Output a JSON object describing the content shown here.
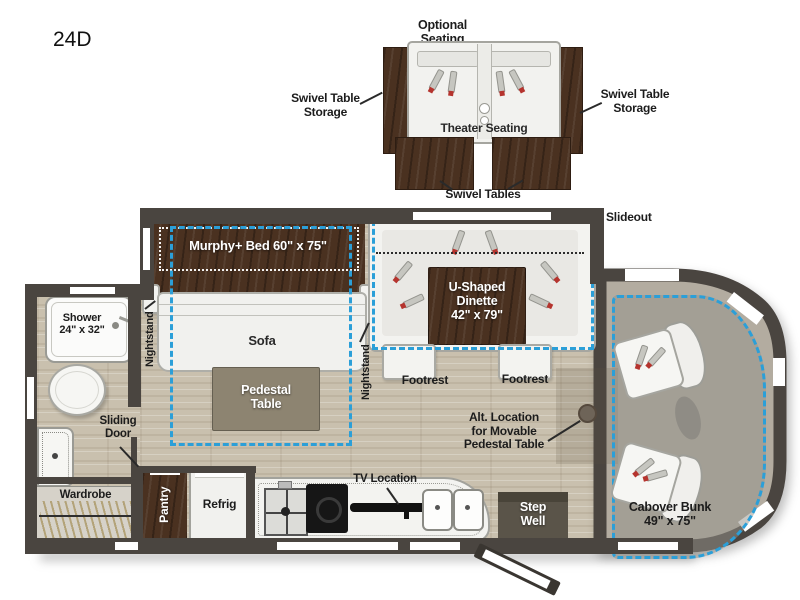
{
  "model": "24D",
  "palette": {
    "wall": "#4a4540",
    "floor": "#c9c0ae",
    "wood": "#4a3120",
    "slideout_dash": "#2b9fd8",
    "furniture_white": "#f3f3f0",
    "cab_floor": "#b3aca0"
  },
  "optional_seating": {
    "title": "Optional Seating",
    "theater_label": "Theater Seating",
    "storage_left": "Swivel Table\nStorage",
    "storage_right": "Swivel Table\nStorage",
    "tables": "Swivel Tables"
  },
  "rooms": {
    "slideout": "Slideout",
    "murphy_bed": "Murphy+ Bed 60\" x 75\"",
    "sofa": "Sofa",
    "nightstand_left": "Nightstand",
    "nightstand_right": "Nightstand",
    "pedestal_table": "Pedestal\nTable",
    "dinette": "U-Shaped\nDinette\n42\" x 79\"",
    "footrest_left": "Footrest",
    "footrest_right": "Footrest",
    "alt_location": "Alt. Location\nfor Movable\nPedestal Table",
    "shower": "Shower\n24\" x 32\"",
    "sliding_door": "Sliding\nDoor",
    "wardrobe": "Wardrobe",
    "pantry": "Pantry",
    "refrig": "Refrig",
    "tv_location": "TV Location",
    "step_well": "Step\nWell",
    "cabover_bunk": "Cabover Bunk\n49\" x 75\""
  }
}
